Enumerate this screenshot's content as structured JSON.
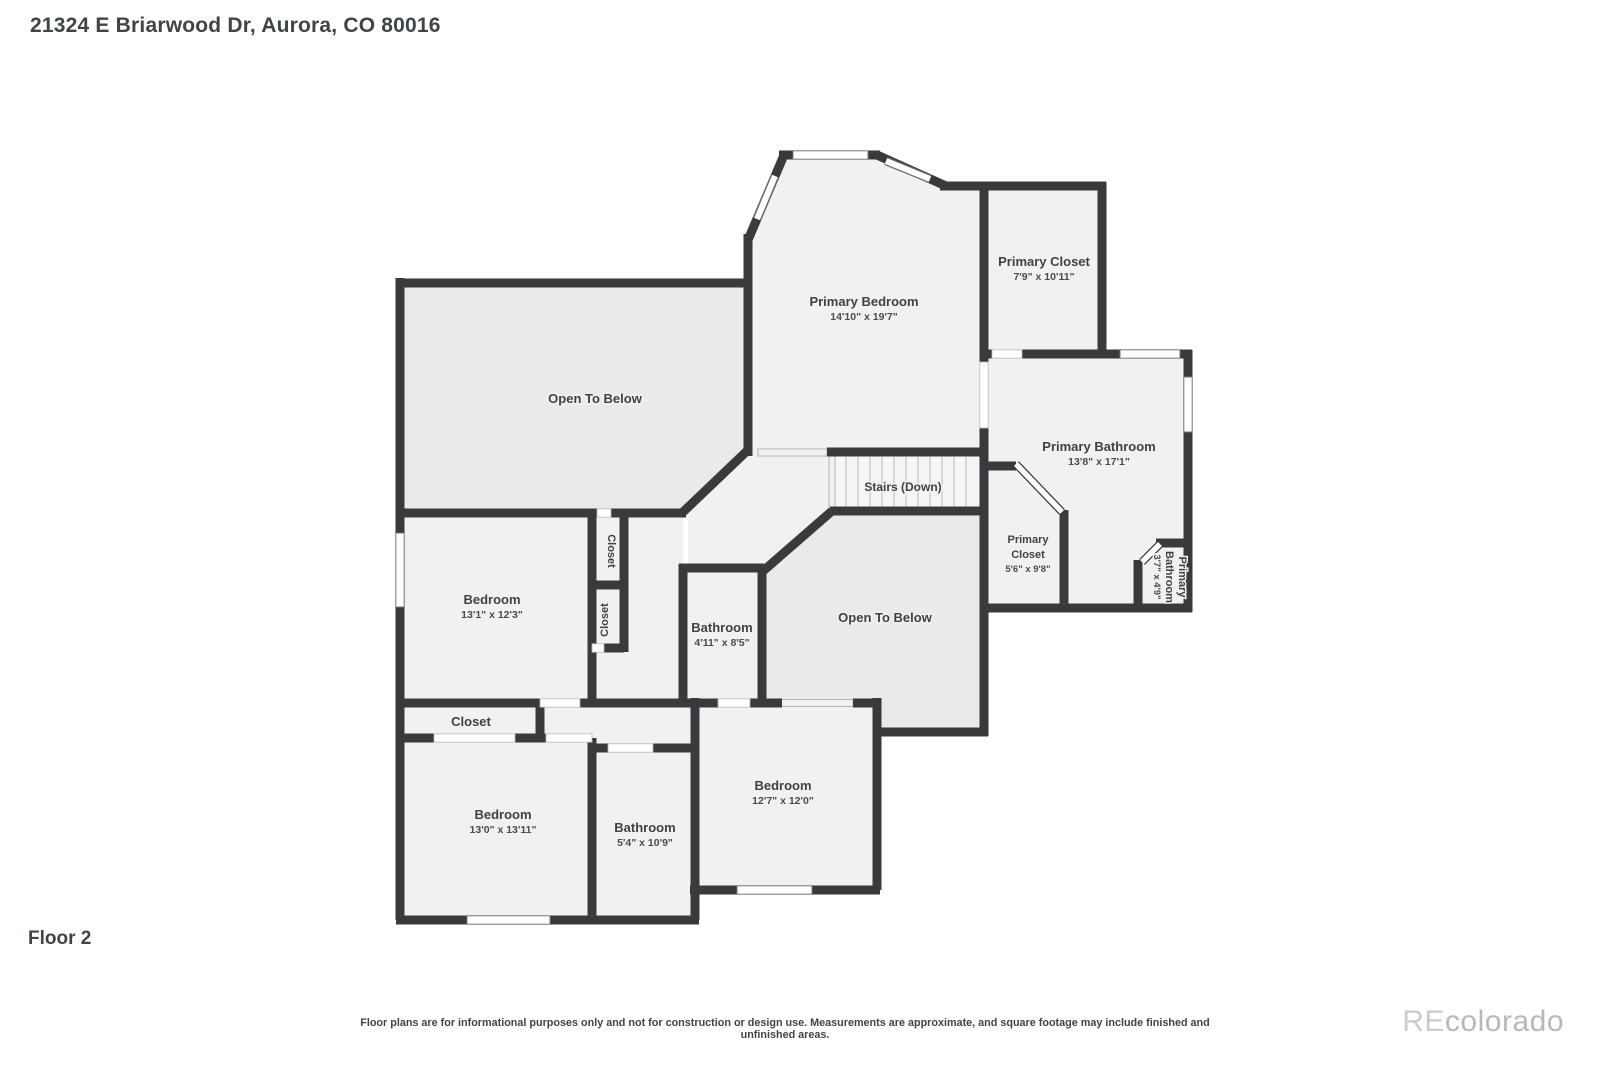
{
  "header": {
    "title": "21324 E Briarwood Dr, Aurora, CO 80016"
  },
  "footer": {
    "floor_label": "Floor 2",
    "disclaimer": "Floor plans are for informational purposes only and not for construction or design use. Measurements are approximate, and square footage may include finished and unfinished areas.",
    "watermark_re": "RE",
    "watermark_rest": "colorado"
  },
  "palette": {
    "wall": "#3a3a3c",
    "room_fill": "#f1f1f0",
    "open_to_below_fill": "#e9eae9",
    "stairs_fill": "#f5f5f4",
    "label_text": "#3e4246",
    "window_fill": "#ffffff"
  },
  "rooms": {
    "open_below_upper": {
      "name": "Open To Below"
    },
    "primary_bedroom": {
      "name": "Primary Bedroom",
      "dims": "14'10\" x 19'7\""
    },
    "primary_closet_large": {
      "name": "Primary Closet",
      "dims": "7'9\" x 10'11\""
    },
    "primary_bathroom_large": {
      "name": "Primary Bathroom",
      "dims": "13'8\" x 17'1\""
    },
    "stairs": {
      "name": "Stairs (Down)"
    },
    "primary_closet_small": {
      "line1": "Primary",
      "line2": "Closet",
      "dims": "5'6\" x 9'8\""
    },
    "primary_bathroom_small": {
      "line1": "Primary",
      "line2": "Bathroom",
      "dims": "3'7\" x 4'9\""
    },
    "open_below_central": {
      "name": "Open To Below"
    },
    "bedroom_1": {
      "name": "Bedroom",
      "dims": "13'1\" x 12'3\""
    },
    "closet_a": {
      "name": "Closet"
    },
    "closet_b": {
      "name": "Closet"
    },
    "bathroom_middle": {
      "name": "Bathroom",
      "dims": "4'11\" x 8'5\""
    },
    "closet_hall": {
      "name": "Closet"
    },
    "bedroom_2": {
      "name": "Bedroom",
      "dims": "13'0\" x 13'11\""
    },
    "bathroom_2": {
      "name": "Bathroom",
      "dims": "5'4\" x 10'9\""
    },
    "bedroom_3": {
      "name": "Bedroom",
      "dims": "12'7\" x 12'0\""
    }
  }
}
